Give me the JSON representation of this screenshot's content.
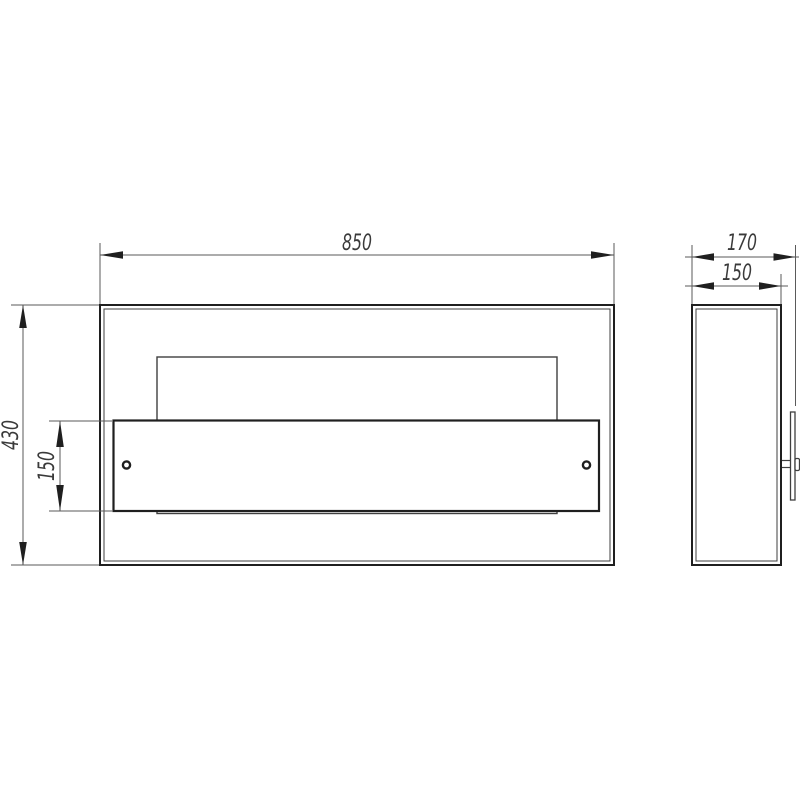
{
  "front_view": {
    "dimensions": {
      "width_mm": "850",
      "height_mm": "430",
      "panel_height_mm": "150"
    }
  },
  "side_view": {
    "dimensions": {
      "depth_overall_mm": "170",
      "depth_body_mm": "150"
    }
  },
  "colors": {
    "background": "#ffffff",
    "object_line": "#1f1f1f",
    "thin_line": "#3f3f3f",
    "dimension_line": "#5a5a5a",
    "dimension_text": "#3a3a3a"
  }
}
